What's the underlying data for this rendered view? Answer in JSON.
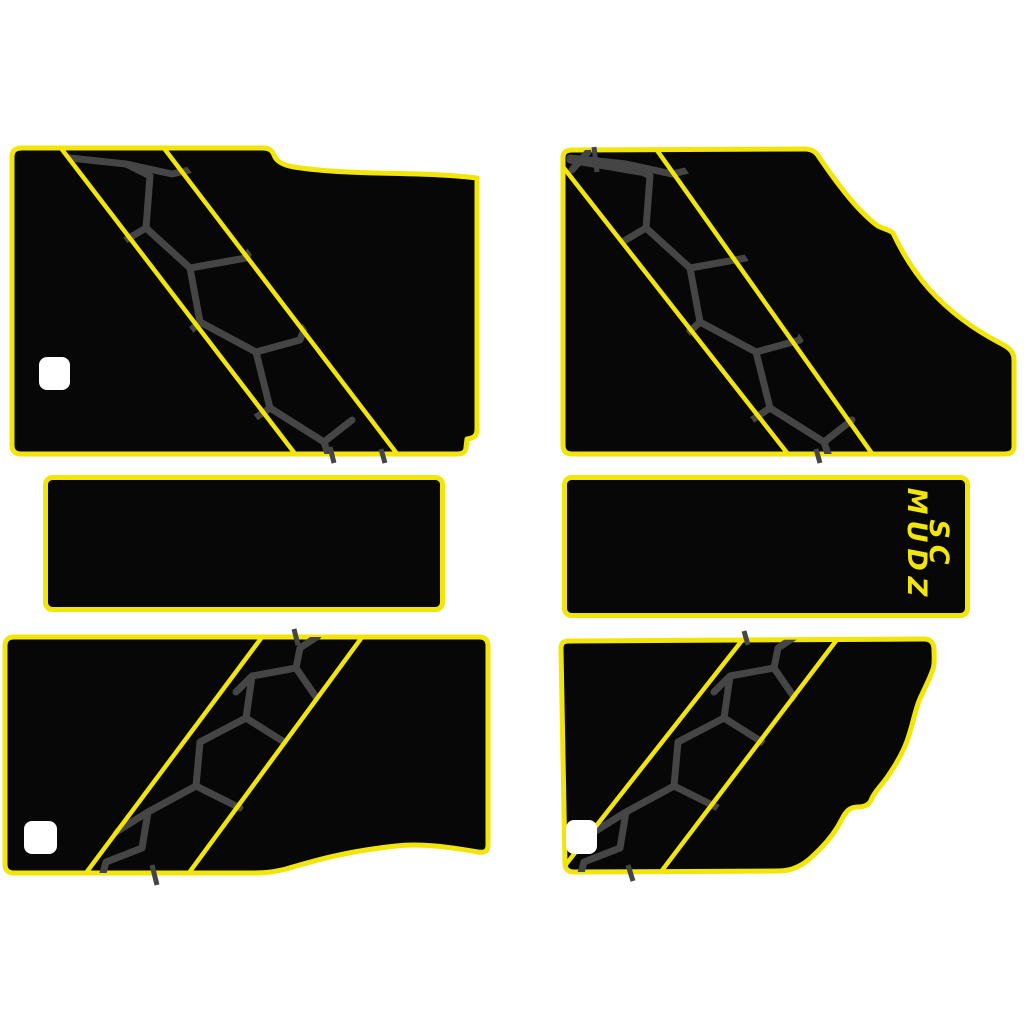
{
  "page": {
    "background_color": "#ffffff"
  },
  "colors": {
    "panel_black": "#070707",
    "accent_yellow": "#f1e50a",
    "pattern_gray": "#454545",
    "cutout_white": "#ffffff"
  },
  "logo": {
    "line1": "SC",
    "line2": "MUDZ"
  }
}
